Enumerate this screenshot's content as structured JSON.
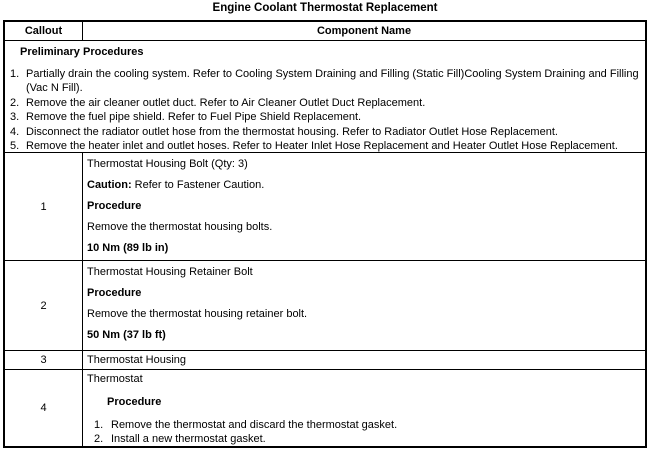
{
  "page": {
    "title": "Engine Coolant Thermostat Replacement"
  },
  "table": {
    "header": {
      "callout": "Callout",
      "component": "Component Name"
    },
    "preliminary": {
      "heading": "Preliminary Procedures",
      "items": [
        {
          "num": "1.",
          "text": "Partially drain the cooling system. Refer to Cooling System Draining and Filling (Static Fill)Cooling System Draining and Filling (Vac N Fill)."
        },
        {
          "num": "2.",
          "text": "Remove the air cleaner outlet duct. Refer to Air Cleaner Outlet Duct Replacement."
        },
        {
          "num": "3.",
          "text": "Remove the fuel pipe shield. Refer to Fuel Pipe Shield Replacement."
        },
        {
          "num": "4.",
          "text": "Disconnect the radiator outlet hose from the thermostat housing. Refer to Radiator Outlet Hose Replacement."
        },
        {
          "num": "5.",
          "text": "Remove the heater inlet and outlet hoses. Refer to Heater Inlet Hose Replacement and Heater Outlet Hose Replacement."
        }
      ]
    },
    "rows": [
      {
        "callout": "1",
        "component": "Thermostat Housing Bolt (Qty: 3)",
        "caution_label": "Caution:",
        "caution_text": " Refer to Fastener Caution.",
        "procedure_label": "Procedure",
        "step": "Remove the thermostat housing bolts.",
        "torque": "10 Nm (89 lb in)"
      },
      {
        "callout": "2",
        "component": "Thermostat Housing Retainer Bolt",
        "procedure_label": "Procedure",
        "step": "Remove the thermostat housing retainer bolt.",
        "torque": "50 Nm (37 lb ft)"
      },
      {
        "callout": "3",
        "component": "Thermostat Housing"
      },
      {
        "callout": "4",
        "component": "Thermostat",
        "procedure_label": "Procedure",
        "steps": [
          {
            "num": "1.",
            "text": "Remove the thermostat and discard the thermostat gasket."
          },
          {
            "num": "2.",
            "text": "Install a new thermostat gasket."
          }
        ]
      }
    ]
  },
  "colors": {
    "border": "#000000",
    "text": "#000000",
    "background": "#ffffff"
  }
}
